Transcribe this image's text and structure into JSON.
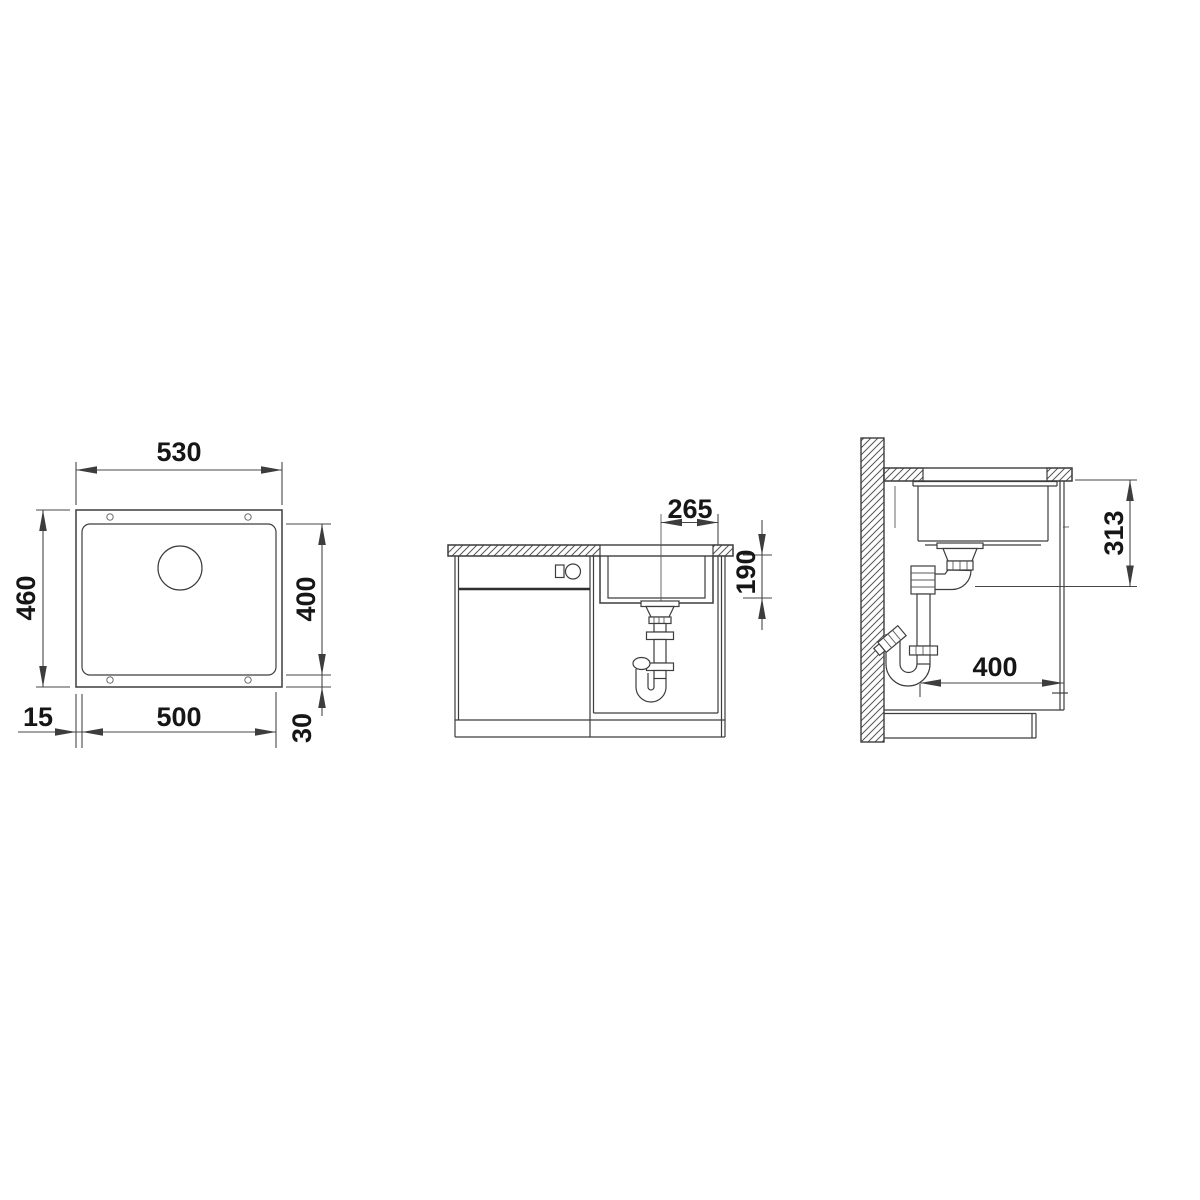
{
  "drawing": {
    "type": "technical-installation-drawing",
    "subject": "undermount-sink",
    "views": [
      "plan",
      "front-section",
      "side-section"
    ]
  },
  "dimensions": {
    "plan_outer_width": "530",
    "plan_outer_depth": "460",
    "plan_bowl_depth": "400",
    "plan_bowl_width": "500",
    "plan_rim_offset_left": "15",
    "plan_rim_offset_bottom": "30",
    "front_drain_offset": "265",
    "front_bowl_depth": "190",
    "side_drain_outlet_height": "313",
    "side_clearance_depth": "400"
  }
}
